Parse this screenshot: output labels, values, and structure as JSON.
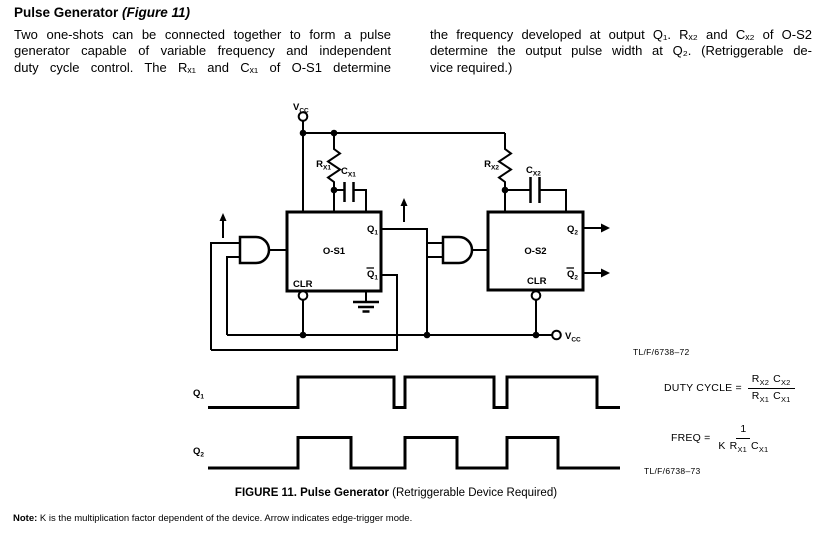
{
  "header": {
    "title_bold": "Pulse Generator ",
    "title_italic": "(Figure 11)",
    "left_lines": [
      "Two one-shots can be connected together to form a pulse",
      "generator capable of variable frequency and independent",
      "duty cycle control. The Rₓ₁ and Cₓ₁ of O-S1 determine"
    ],
    "right_lines": [
      "the frequency developed at output Q₁. Rₓ₂ and Cₓ₂ of O-S2",
      "determine the output pulse width at Q₂. (Retriggerable de-",
      "vice required.)"
    ]
  },
  "circuit": {
    "vcc_top": {
      "base": "V",
      "sub": "CC"
    },
    "vcc_bottom": {
      "base": "V",
      "sub": "CC"
    },
    "rx1": {
      "base": "R",
      "sub": "X1"
    },
    "cx1": {
      "base": "C",
      "sub": "X1"
    },
    "rx2": {
      "base": "R",
      "sub": "X2"
    },
    "cx2": {
      "base": "C",
      "sub": "X2"
    },
    "os1": {
      "name": "O-S1",
      "q_base": "Q",
      "q_sub": "1",
      "qbar_base": "Q",
      "qbar_sub": "1",
      "clr": "CLR"
    },
    "os2": {
      "name": "O-S2",
      "q_base": "Q",
      "q_sub": "2",
      "qbar_base": "Q",
      "qbar_sub": "2",
      "clr": "CLR"
    },
    "ref": "TL/F/6738–72"
  },
  "waveforms": {
    "q1_base": "Q",
    "q1_sub": "1",
    "q2_base": "Q",
    "q2_sub": "2"
  },
  "formulas": {
    "duty_label": "DUTY CYCLE =",
    "duty_num_rb": "R",
    "duty_num_rs": "X2",
    "duty_num_cb": "C",
    "duty_num_cs": "X2",
    "duty_den_rb": "R",
    "duty_den_rs": "X1",
    "duty_den_cb": "C",
    "duty_den_cs": "X1",
    "freq_label": "FREQ =",
    "freq_num": "1",
    "freq_den_k": "K",
    "freq_den_rb": "R",
    "freq_den_rs": "X1",
    "freq_den_cb": "C",
    "freq_den_cs": "X1",
    "ref": "TL/F/6738–73"
  },
  "caption": {
    "bold": "FIGURE 11. Pulse Generator",
    "regular": " (Retriggerable Device Required)"
  },
  "note": {
    "bold": "Note:",
    "text": " K is the multiplication factor dependent of the device. Arrow indicates edge-trigger mode."
  }
}
